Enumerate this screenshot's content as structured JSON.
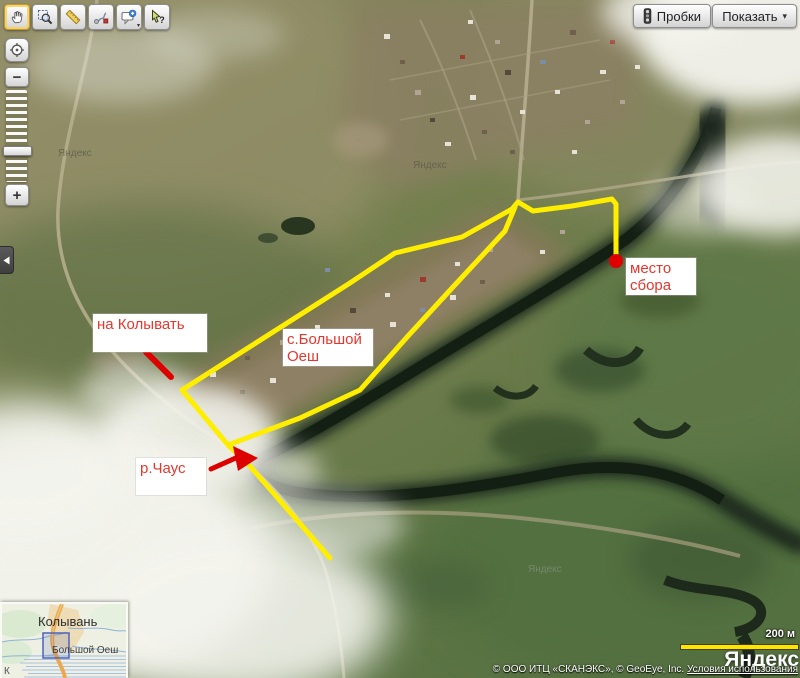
{
  "toolbar": {
    "tools": [
      {
        "name": "pan",
        "icon": "hand-icon",
        "active": true
      },
      {
        "name": "zoom-selection",
        "icon": "magnifier-icon",
        "active": false
      },
      {
        "name": "measure-distance",
        "icon": "ruler-icon",
        "active": false
      },
      {
        "name": "draw-route",
        "icon": "route-icon",
        "active": false
      },
      {
        "name": "add-comment",
        "icon": "comment-plus-icon",
        "active": false
      },
      {
        "name": "whats-here",
        "icon": "cursor-question-icon",
        "active": false
      }
    ]
  },
  "header": {
    "traffic_button": {
      "label": "Пробки",
      "icon": "traffic-light-icon"
    },
    "show_button": {
      "label": "Показать",
      "arrow": "▾",
      "icon": "chevron-down-icon"
    }
  },
  "zoom_control": {
    "minus": "−",
    "plus": "+",
    "locate_icon": "target-icon",
    "collapse_icon": "chevron-left-icon"
  },
  "annotations": {
    "route_color": "#ffee00",
    "marker_color": "#e10000",
    "text_color": "#e3372e",
    "labels": [
      {
        "id": "na-kolyvat",
        "line1": "на Колывать",
        "line2": ""
      },
      {
        "id": "s-bolshoy-oesh",
        "line1": "с.Большой",
        "line2": "Оеш"
      },
      {
        "id": "mesto-sbora",
        "line1": "место",
        "line2": "сбора"
      },
      {
        "id": "r-chaus",
        "line1": "р.Чаус",
        "line2": ""
      }
    ]
  },
  "minimap": {
    "city": "Колывань",
    "village": "Большой Оеш",
    "edge_label": "К"
  },
  "scale_bar": {
    "label": "200 м"
  },
  "branding": {
    "logo": "Яндекс",
    "watermark": "Яндекс"
  },
  "attribution": {
    "providers": "© ООО ИТЦ «СКАНЭКС», © GeoEye, Inc.",
    "terms": "Условия использования"
  }
}
